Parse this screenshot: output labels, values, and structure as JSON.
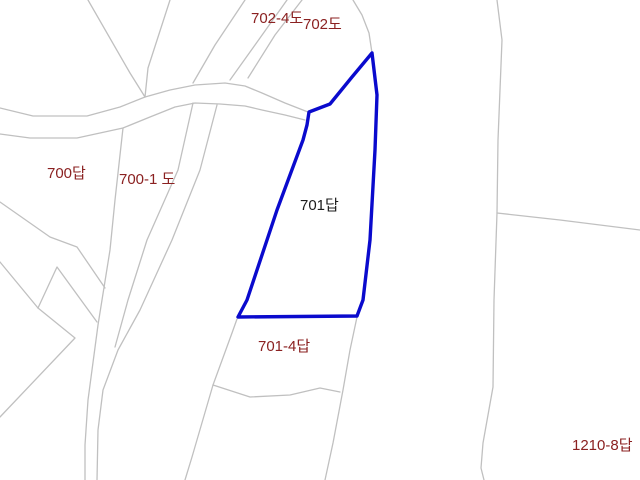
{
  "map": {
    "width": 640,
    "height": 480,
    "background_color": "#ffffff",
    "boundary_color": "#c0c0c0",
    "highlight_color": "#0a0acd",
    "label_default_color": "#8b2121",
    "labels": [
      {
        "text": "702-4도",
        "x": 251,
        "y": 11,
        "color": "#8b2121"
      },
      {
        "text": "702도",
        "x": 303,
        "y": 17,
        "color": "#8b2121"
      },
      {
        "text": "700답",
        "x": 47,
        "y": 166,
        "color": "#8b2121"
      },
      {
        "text": "700-1 도",
        "x": 119,
        "y": 172,
        "color": "#8b2121"
      },
      {
        "text": "701답",
        "x": 300,
        "y": 198,
        "color": "#1c1c1c"
      },
      {
        "text": "701-4답",
        "x": 258,
        "y": 339,
        "color": "#8b2121"
      },
      {
        "text": "1210-8답",
        "x": 572,
        "y": 438,
        "color": "#8b2121"
      }
    ],
    "highlight_parcel": {
      "label": "701답",
      "points": [
        [
          372,
          53
        ],
        [
          352,
          77
        ],
        [
          330,
          104
        ],
        [
          309,
          112
        ],
        [
          307,
          125
        ],
        [
          303,
          140
        ],
        [
          277,
          210
        ],
        [
          247,
          300
        ],
        [
          238,
          317
        ],
        [
          357,
          316
        ],
        [
          363,
          300
        ],
        [
          370,
          240
        ],
        [
          375,
          150
        ],
        [
          377,
          95
        ]
      ]
    },
    "boundaries": [
      {
        "name": "road-upper-edge",
        "points": [
          [
            0,
            108
          ],
          [
            33,
            116
          ],
          [
            87,
            116
          ],
          [
            120,
            107
          ],
          [
            145,
            97
          ],
          [
            170,
            90
          ],
          [
            195,
            85
          ],
          [
            225,
            83
          ],
          [
            245,
            86
          ],
          [
            262,
            93
          ],
          [
            285,
            103
          ],
          [
            308,
            112
          ]
        ]
      },
      {
        "name": "road-lower-edge",
        "points": [
          [
            0,
            134
          ],
          [
            30,
            138
          ],
          [
            77,
            138
          ],
          [
            123,
            128
          ],
          [
            150,
            117
          ],
          [
            175,
            107
          ],
          [
            195,
            103
          ],
          [
            220,
            104
          ],
          [
            245,
            106
          ],
          [
            262,
            110
          ],
          [
            285,
            115
          ],
          [
            305,
            120
          ]
        ]
      },
      {
        "name": "northwest-diagonal-a",
        "points": [
          [
            88,
            0
          ],
          [
            130,
            73
          ],
          [
            145,
            97
          ]
        ]
      },
      {
        "name": "northwest-diagonal-b",
        "points": [
          [
            170,
            0
          ],
          [
            148,
            68
          ],
          [
            145,
            97
          ]
        ]
      },
      {
        "name": "north-diagonal-c",
        "points": [
          [
            245,
            0
          ],
          [
            215,
            45
          ],
          [
            193,
            83
          ]
        ]
      },
      {
        "name": "north-diagonal-d",
        "points": [
          [
            287,
            0
          ],
          [
            255,
            45
          ],
          [
            230,
            80
          ]
        ]
      },
      {
        "name": "north-diagonal-e",
        "points": [
          [
            302,
            0
          ],
          [
            275,
            35
          ],
          [
            248,
            78
          ]
        ]
      },
      {
        "name": "parcel-702-dome-edge",
        "points": [
          [
            353,
            0
          ],
          [
            362,
            15
          ],
          [
            369,
            33
          ],
          [
            372,
            53
          ]
        ]
      },
      {
        "name": "path-700-1-west-edge",
        "points": [
          [
            123,
            128
          ],
          [
            115,
            200
          ],
          [
            110,
            250
          ],
          [
            98,
            325
          ],
          [
            88,
            400
          ],
          [
            85,
            445
          ],
          [
            85,
            480
          ]
        ]
      },
      {
        "name": "path-700-1-east-edge",
        "points": [
          [
            193,
            103
          ],
          [
            178,
            170
          ],
          [
            147,
            240
          ],
          [
            128,
            300
          ],
          [
            115,
            347
          ]
        ]
      },
      {
        "name": "path-700-1-outer-east-edge",
        "points": [
          [
            217,
            105
          ],
          [
            200,
            170
          ],
          [
            172,
            240
          ],
          [
            140,
            310
          ],
          [
            118,
            350
          ],
          [
            103,
            390
          ],
          [
            98,
            430
          ],
          [
            97,
            480
          ]
        ]
      },
      {
        "name": "west-zigzag-a",
        "points": [
          [
            0,
            202
          ],
          [
            50,
            237
          ],
          [
            77,
            247
          ],
          [
            105,
            288
          ]
        ]
      },
      {
        "name": "west-zigzag-b",
        "points": [
          [
            0,
            262
          ],
          [
            38,
            308
          ]
        ]
      },
      {
        "name": "west-spike",
        "points": [
          [
            38,
            308
          ],
          [
            57,
            267
          ],
          [
            97,
            322
          ]
        ]
      },
      {
        "name": "west-zigzag-c",
        "points": [
          [
            0,
            417
          ],
          [
            75,
            338
          ],
          [
            38,
            308
          ]
        ]
      },
      {
        "name": "parcel-701-4-west-edge",
        "points": [
          [
            237,
            319
          ],
          [
            232,
            333
          ],
          [
            213,
            385
          ],
          [
            192,
            457
          ],
          [
            185,
            480
          ]
        ]
      },
      {
        "name": "parcel-701-4-south-boundary",
        "points": [
          [
            213,
            385
          ],
          [
            250,
            397
          ],
          [
            290,
            395
          ],
          [
            320,
            388
          ],
          [
            340,
            392
          ]
        ]
      },
      {
        "name": "parcel-701-4-east-edge",
        "points": [
          [
            357,
            317
          ],
          [
            350,
            350
          ],
          [
            343,
            390
          ],
          [
            333,
            443
          ],
          [
            325,
            480
          ]
        ]
      },
      {
        "name": "east-long-boundary",
        "points": [
          [
            497,
            0
          ],
          [
            502,
            40
          ],
          [
            498,
            140
          ],
          [
            497,
            213
          ],
          [
            494,
            300
          ],
          [
            493,
            387
          ],
          [
            483,
            443
          ],
          [
            481,
            468
          ],
          [
            484,
            480
          ]
        ]
      },
      {
        "name": "east-branch-boundary",
        "points": [
          [
            497,
            213
          ],
          [
            560,
            220
          ],
          [
            640,
            230
          ]
        ]
      }
    ]
  }
}
